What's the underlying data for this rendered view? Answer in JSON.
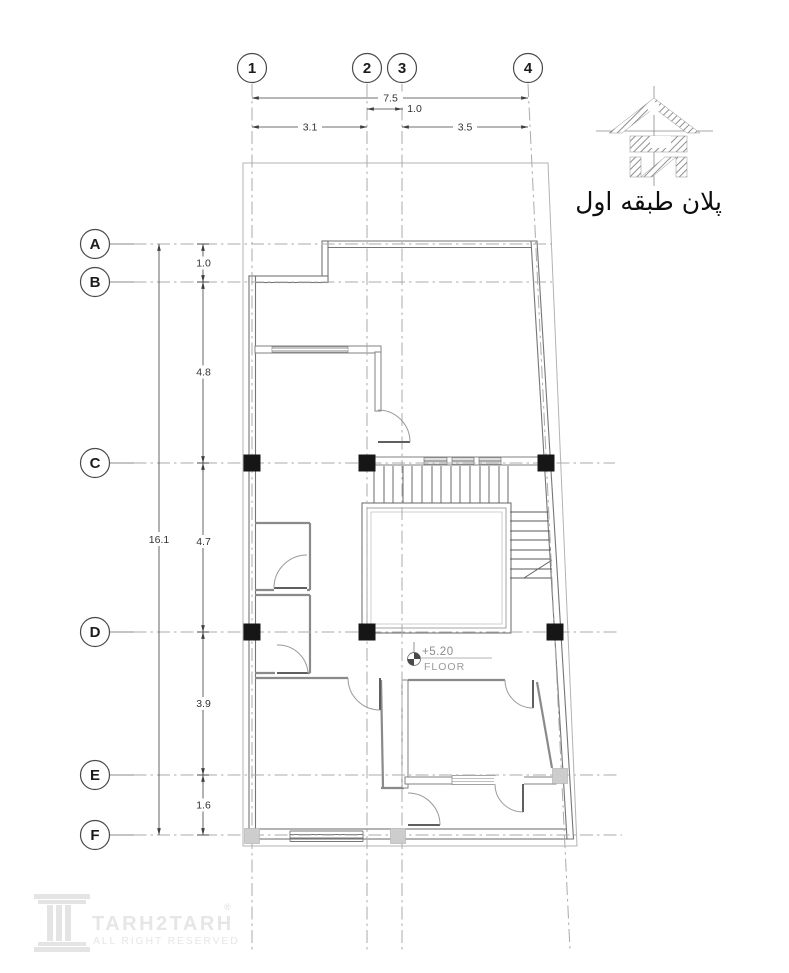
{
  "plan": {
    "title": "پلان طبقه اول",
    "grid": {
      "columns": [
        "1",
        "2",
        "3",
        "4"
      ],
      "rows": [
        "A",
        "B",
        "C",
        "D",
        "E",
        "F"
      ]
    },
    "dimensions": {
      "top": {
        "total": "7.5",
        "c1_c2": "3.1",
        "c2_c3": "1.0",
        "c3_c4": "3.5"
      },
      "left": {
        "total": "16.1",
        "a_b": "1.0",
        "b_c": "4.8",
        "c_d": "4.7",
        "d_e": "3.9",
        "e_f": "1.6"
      }
    },
    "level_marker": {
      "value": "+5.20",
      "label": "FLOOR"
    }
  },
  "watermark": {
    "name": "TARH2TARH",
    "registered": "®",
    "subtitle": "ALL RIGHT RESERVED"
  },
  "colors": {
    "line": "#7a7a7a",
    "grid_line": "#ababab",
    "column_fill": "#161616",
    "column_light": "#cdcdcd",
    "window_fill": "#c6c6c6",
    "dim_text": "#333333",
    "watermark": "#e6e6e6"
  }
}
